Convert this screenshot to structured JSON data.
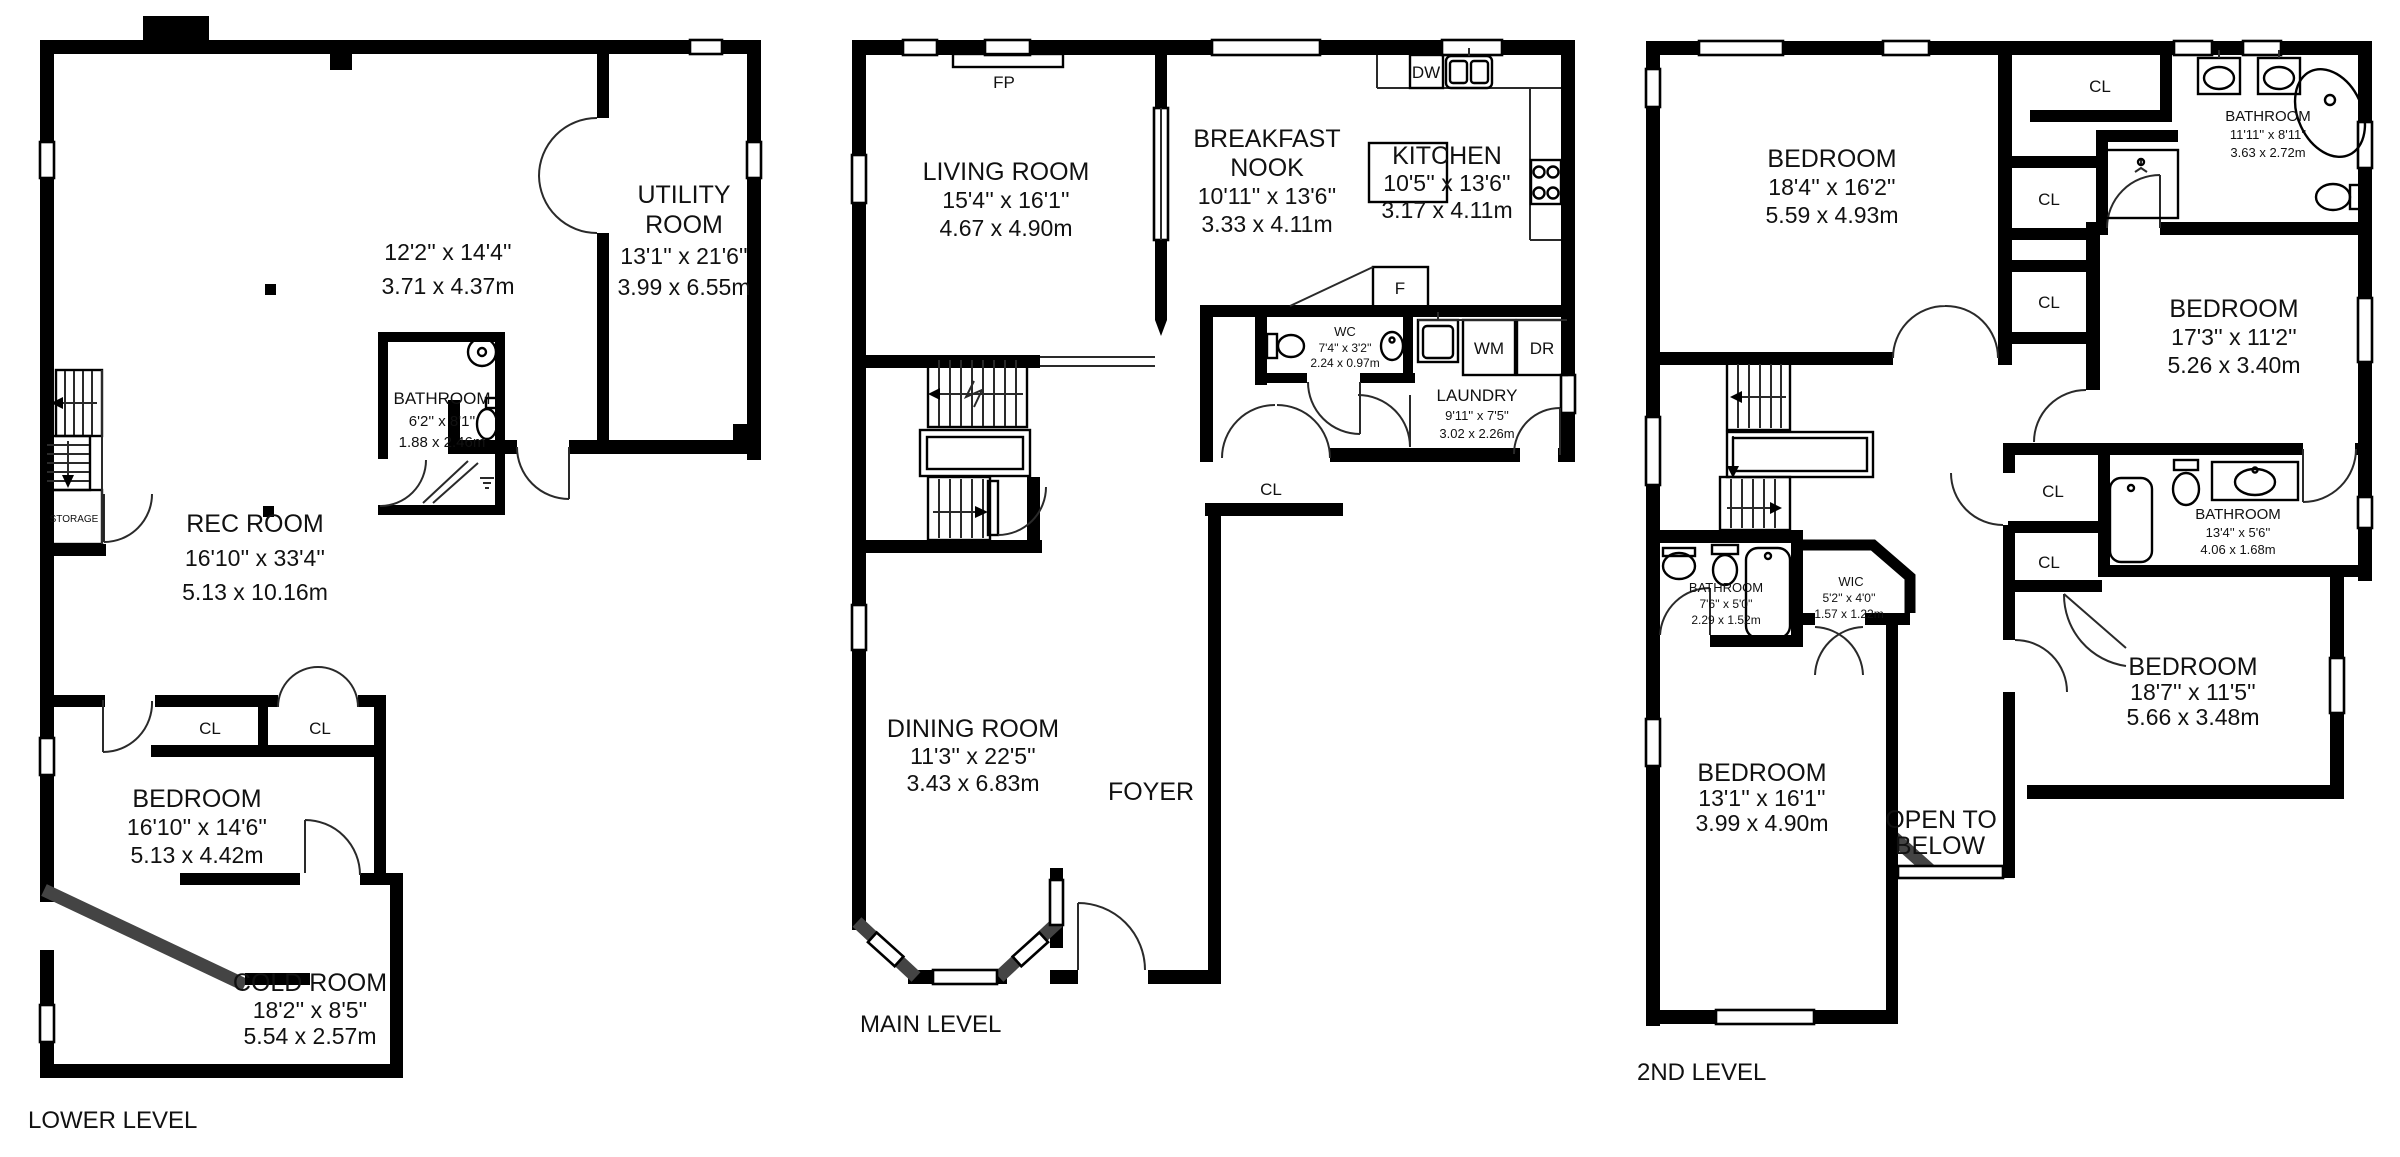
{
  "plans": [
    {
      "level_label": "LOWER LEVEL",
      "rooms": [
        {
          "name": "",
          "ft": "12'2'' x 14'4''",
          "m": "3.71 x 4.37m"
        },
        {
          "name": "UTILITY",
          "name2": "ROOM",
          "ft": "13'1'' x 21'6''",
          "m": "3.99 x 6.55m"
        },
        {
          "name": "REC ROOM",
          "ft": "16'10'' x 33'4''",
          "m": "5.13 x 10.16m"
        },
        {
          "name": "BATHROOM",
          "ft": "6'2'' x 8'1''",
          "m": "1.88 x 2.46m"
        },
        {
          "name": "BEDROOM",
          "ft": "16'10'' x 14'6''",
          "m": "5.13 x 4.42m"
        },
        {
          "name": "COLD ROOM",
          "ft": "18'2'' x 8'5''",
          "m": "5.54 x 2.57m"
        }
      ],
      "labels": {
        "storage": "STORAGE",
        "cl1": "CL",
        "cl2": "CL"
      }
    },
    {
      "level_label": "MAIN LEVEL",
      "rooms": [
        {
          "name": "LIVING ROOM",
          "ft": "15'4'' x 16'1''",
          "m": "4.67 x 4.90m"
        },
        {
          "name": "BREAKFAST",
          "name2": "NOOK",
          "ft": "10'11'' x 13'6''",
          "m": "3.33 x 4.11m"
        },
        {
          "name": "KITCHEN",
          "ft": "10'5'' x 13'6''",
          "m": "3.17 x 4.11m"
        },
        {
          "name": "WC",
          "ft": "7'4'' x 3'2''",
          "m": "2.24 x 0.97m"
        },
        {
          "name": "LAUNDRY",
          "ft": "9'11'' x 7'5''",
          "m": "3.02 x 2.26m"
        },
        {
          "name": "DINING ROOM",
          "ft": "11'3'' x 22'5''",
          "m": "3.43 x 6.83m"
        },
        {
          "name": "FOYER"
        }
      ],
      "labels": {
        "fp": "FP",
        "dw": "DW",
        "fridge": "F",
        "wm": "WM",
        "dr": "DR",
        "cl": "CL"
      }
    },
    {
      "level_label": "2ND LEVEL",
      "rooms": [
        {
          "name": "BEDROOM",
          "ft": "18'4'' x 16'2''",
          "m": "5.59 x 4.93m"
        },
        {
          "name": "BATHROOM",
          "ft": "11'11'' x 8'11''",
          "m": "3.63 x 2.72m"
        },
        {
          "name": "BEDROOM",
          "ft": "17'3'' x 11'2''",
          "m": "5.26 x 3.40m"
        },
        {
          "name": "BATHROOM",
          "ft": "13'4'' x 5'6''",
          "m": "4.06 x 1.68m"
        },
        {
          "name": "BEDROOM",
          "ft": "18'7'' x 11'5''",
          "m": "5.66 x 3.48m"
        },
        {
          "name": "BATHROOM",
          "ft": "7'6'' x 5'0''",
          "m": "2.29 x 1.52m"
        },
        {
          "name": "WIC",
          "ft": "5'2'' x 4'0''",
          "m": "1.57 x 1.22m"
        },
        {
          "name": "BEDROOM",
          "ft": "13'1'' x 16'1''",
          "m": "3.99 x 4.90m"
        },
        {
          "name": "OPEN TO",
          "name2": "BELOW"
        }
      ],
      "labels": {
        "cl_top": "CL",
        "cl_a": "CL",
        "cl_b": "CL",
        "cl_c": "CL",
        "cl_d": "CL"
      }
    }
  ]
}
